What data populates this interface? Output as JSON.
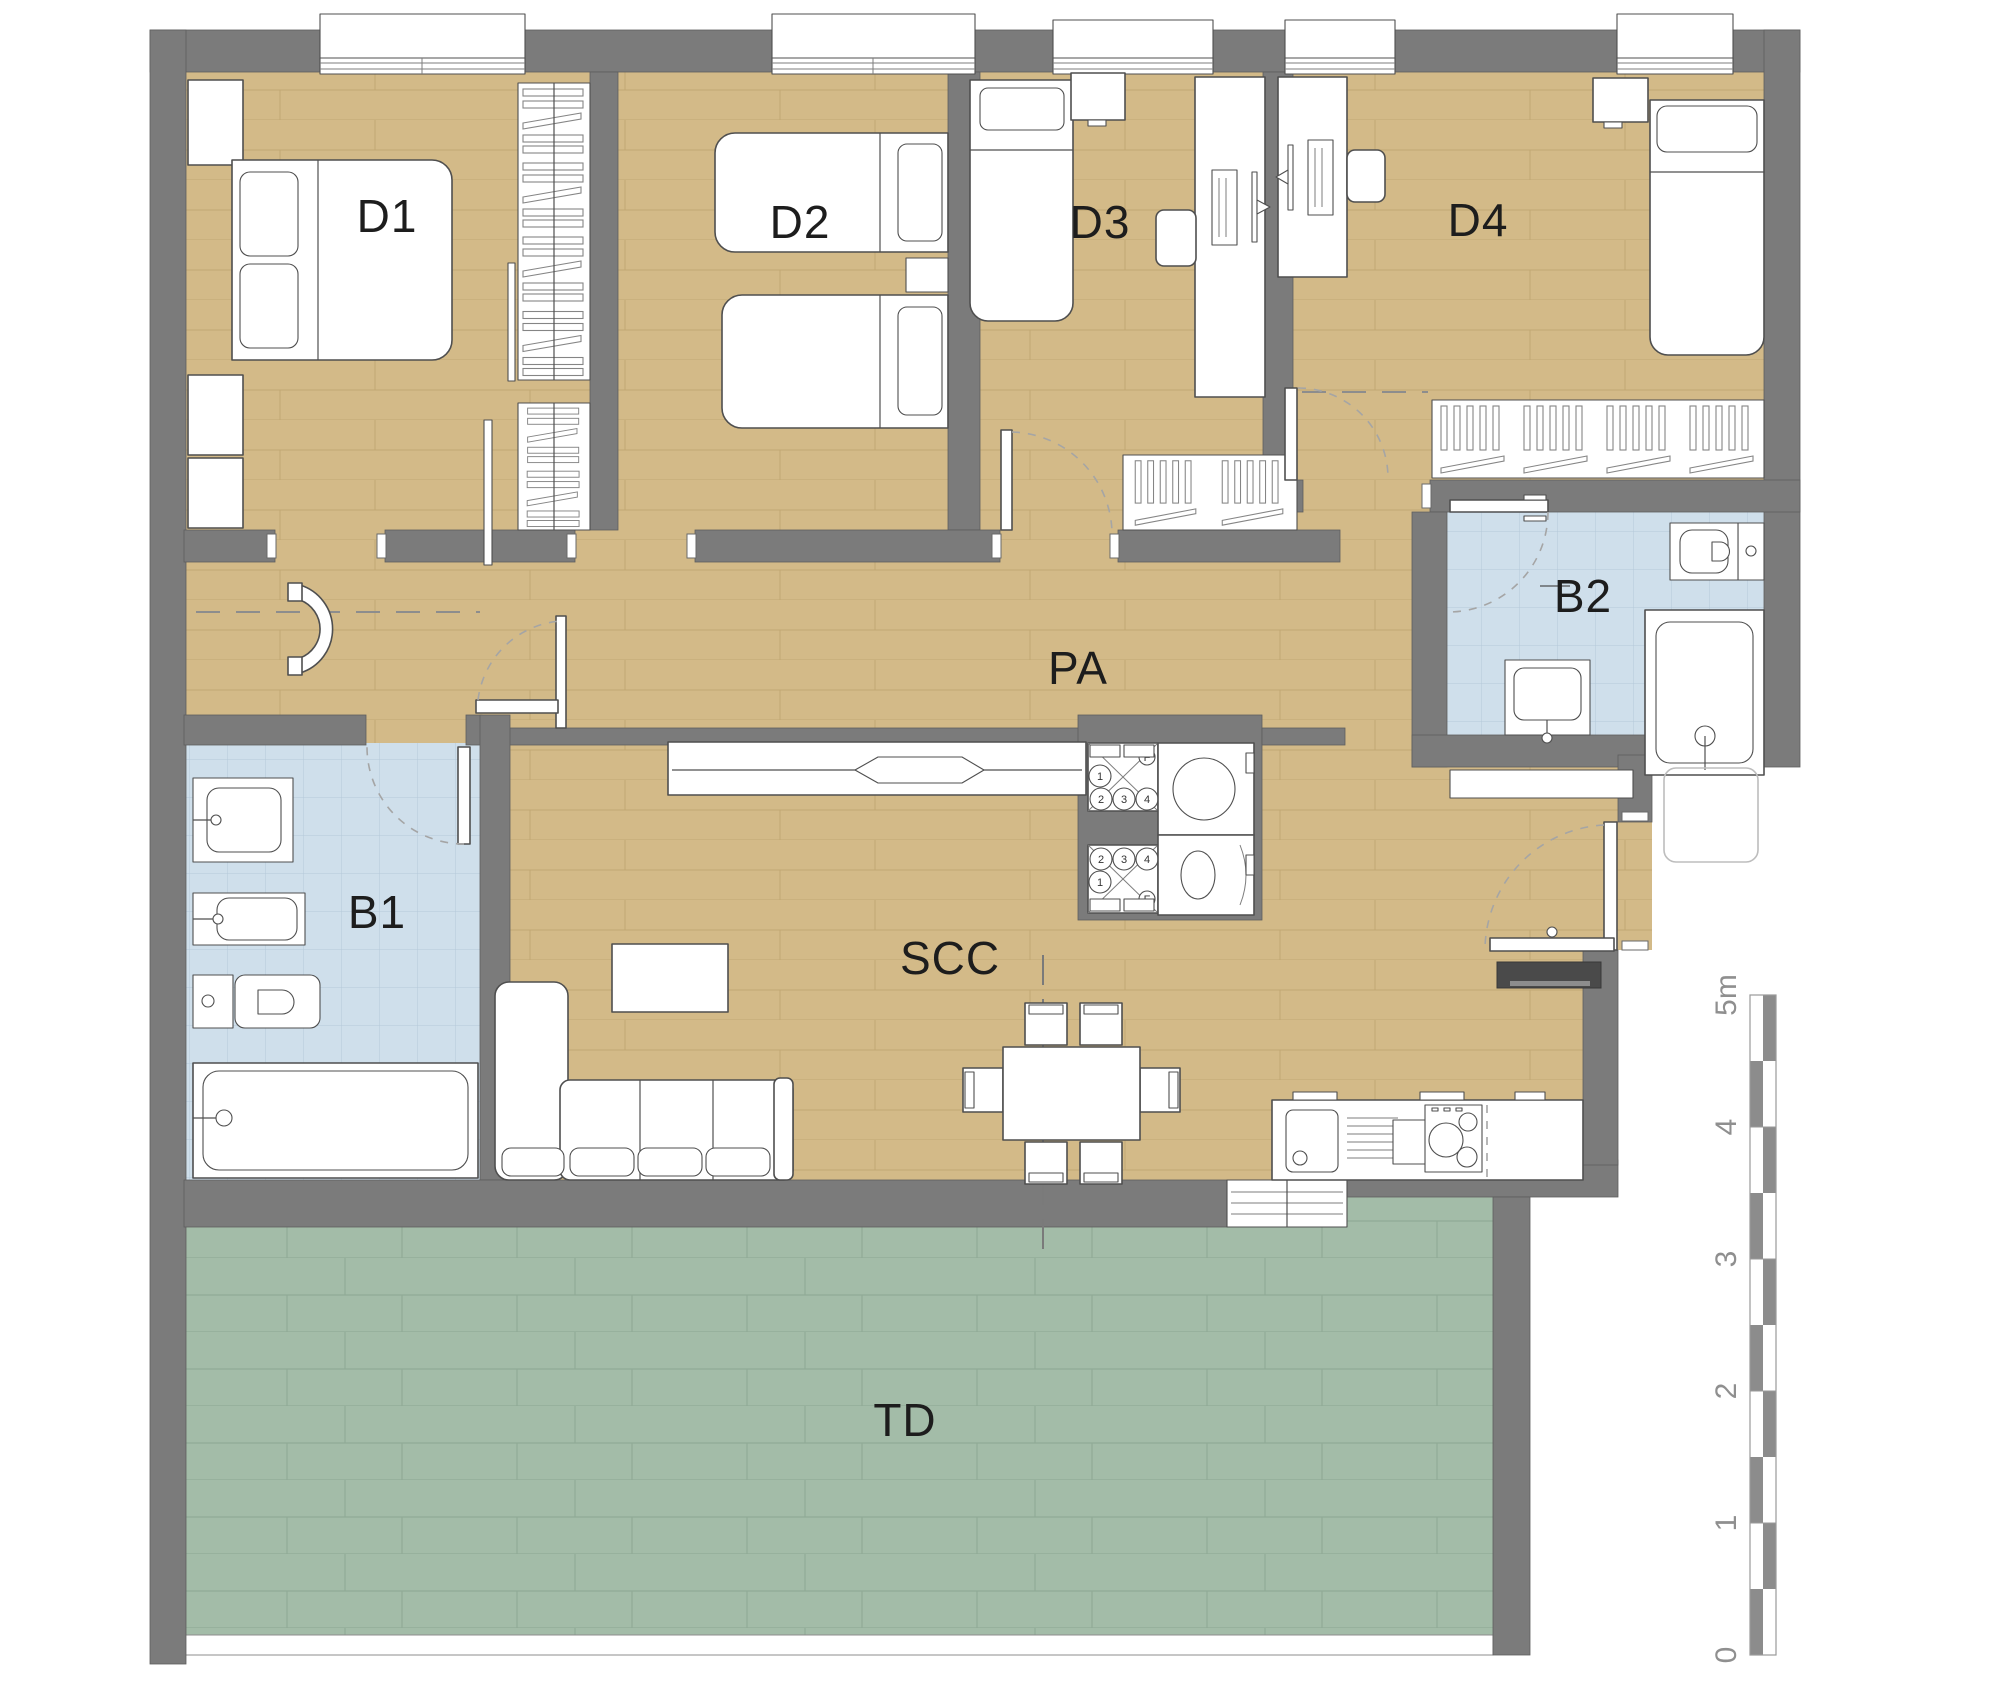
{
  "plan": {
    "type": "apartment-floor-plan",
    "rooms": [
      {
        "id": "d1",
        "label": "D1"
      },
      {
        "id": "d2",
        "label": "D2"
      },
      {
        "id": "d3",
        "label": "D3"
      },
      {
        "id": "d4",
        "label": "D4"
      },
      {
        "id": "pa",
        "label": "PA"
      },
      {
        "id": "b1",
        "label": "B1"
      },
      {
        "id": "b2",
        "label": "B2"
      },
      {
        "id": "scc",
        "label": "SCC"
      },
      {
        "id": "td",
        "label": "TD"
      }
    ],
    "appliance_dial_labels": [
      "1",
      "2",
      "3",
      "4",
      "F"
    ],
    "scale_bar": {
      "labels": [
        "0",
        "1",
        "2",
        "3",
        "4",
        "5m"
      ]
    },
    "colors": {
      "wall": "#7b7b7b",
      "wood": "#d3ba88",
      "wood_line": "#c2a873",
      "tile": "#cfdfeb",
      "tile_line": "#b4c8da",
      "terrace": "#a3bca8",
      "terrace_line": "#90aa96",
      "line": "#4f4f4f"
    }
  }
}
